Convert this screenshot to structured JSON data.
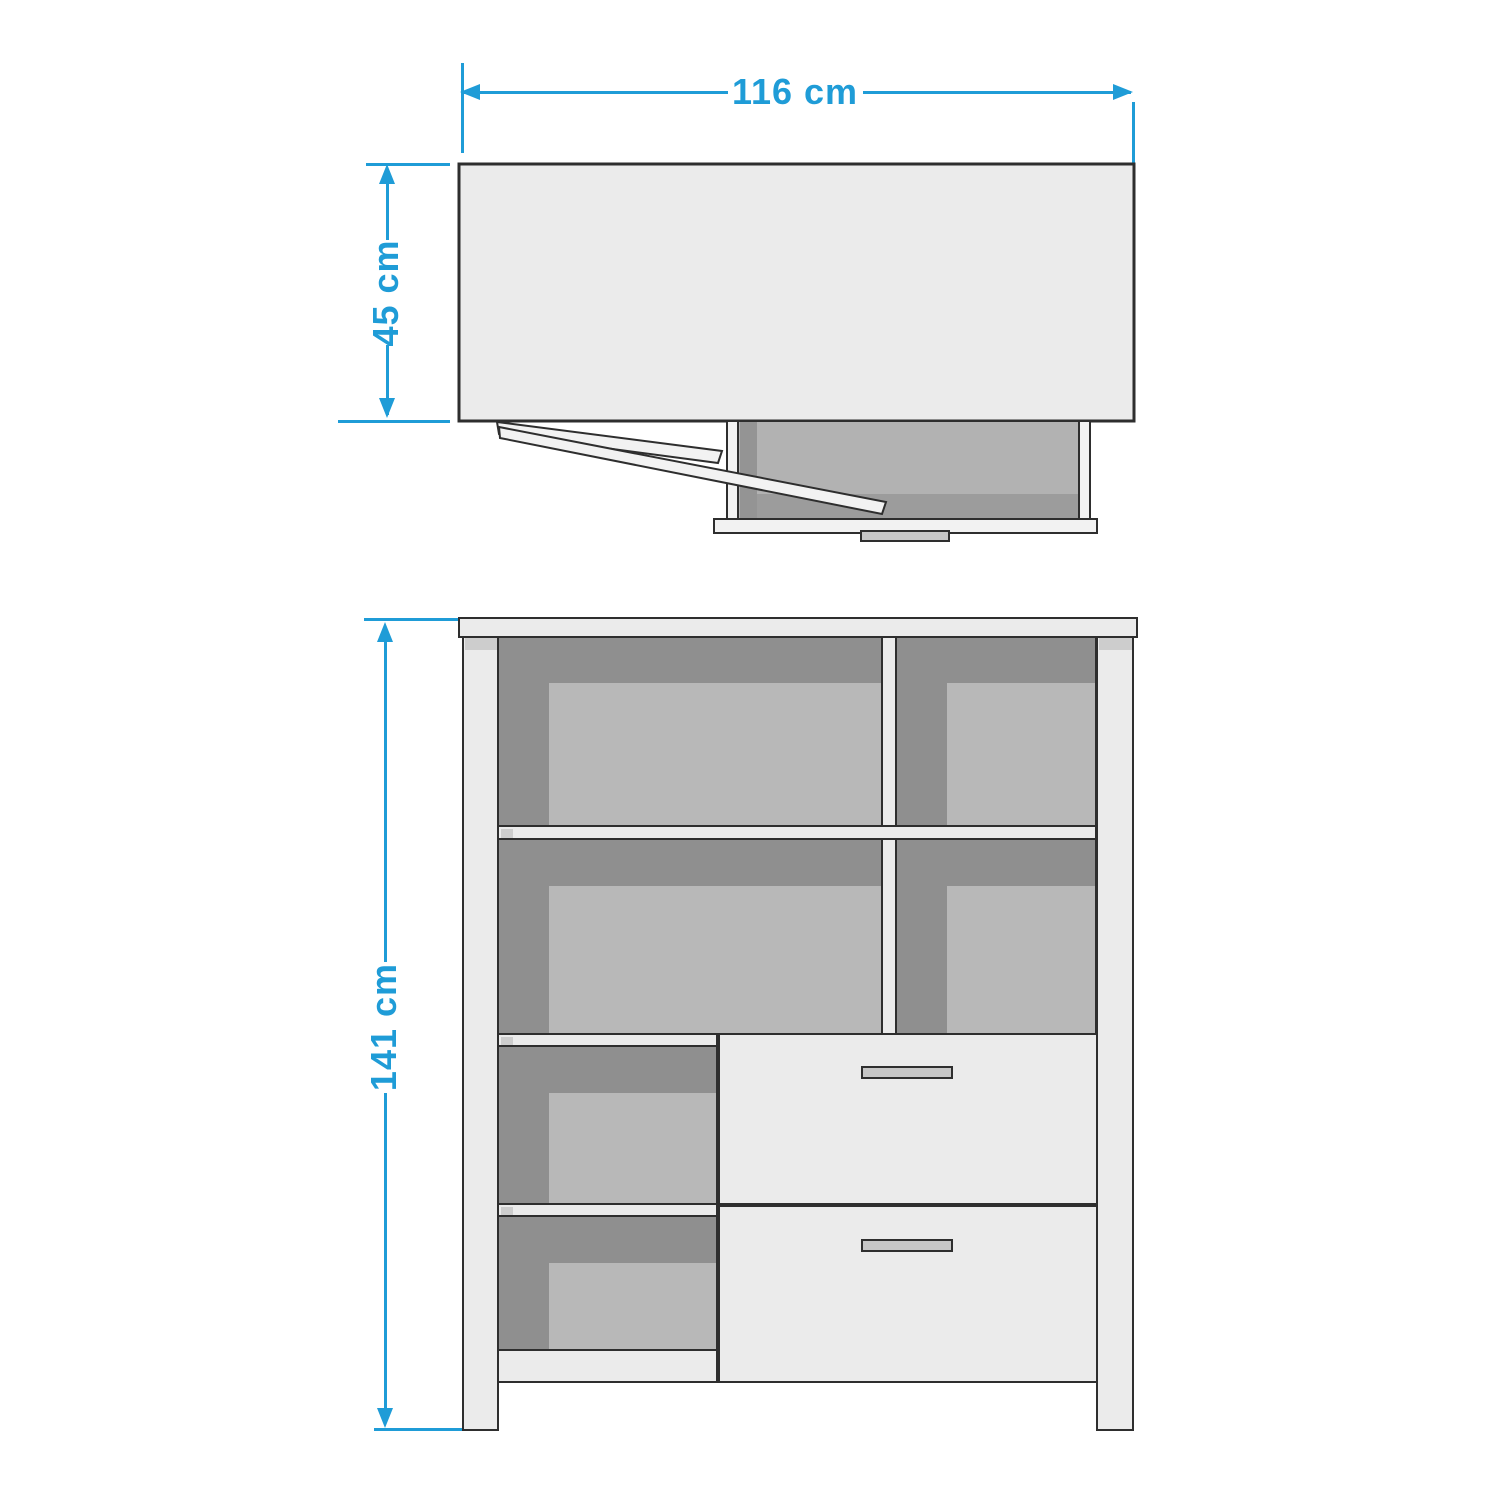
{
  "theme": {
    "accent": "#1f9cd7",
    "outline": "#2e2e2e",
    "panel_light": "#ebebeb",
    "panel_lighter": "#f2f2f2",
    "shade_dark": "#8f8f8f",
    "shade_mid": "#b8b8b8",
    "interior_main": "#b2b2b2",
    "interior_band": "#9c9c9c",
    "interior_left_band": "#949494",
    "handle_fill": "#c6c6c6",
    "cap_gray": "#cdcdcd",
    "background": "#ffffff"
  },
  "top_view": {
    "width_label": "116 cm",
    "depth_label": "45 cm"
  },
  "front_view": {
    "height_label": "141 cm"
  }
}
